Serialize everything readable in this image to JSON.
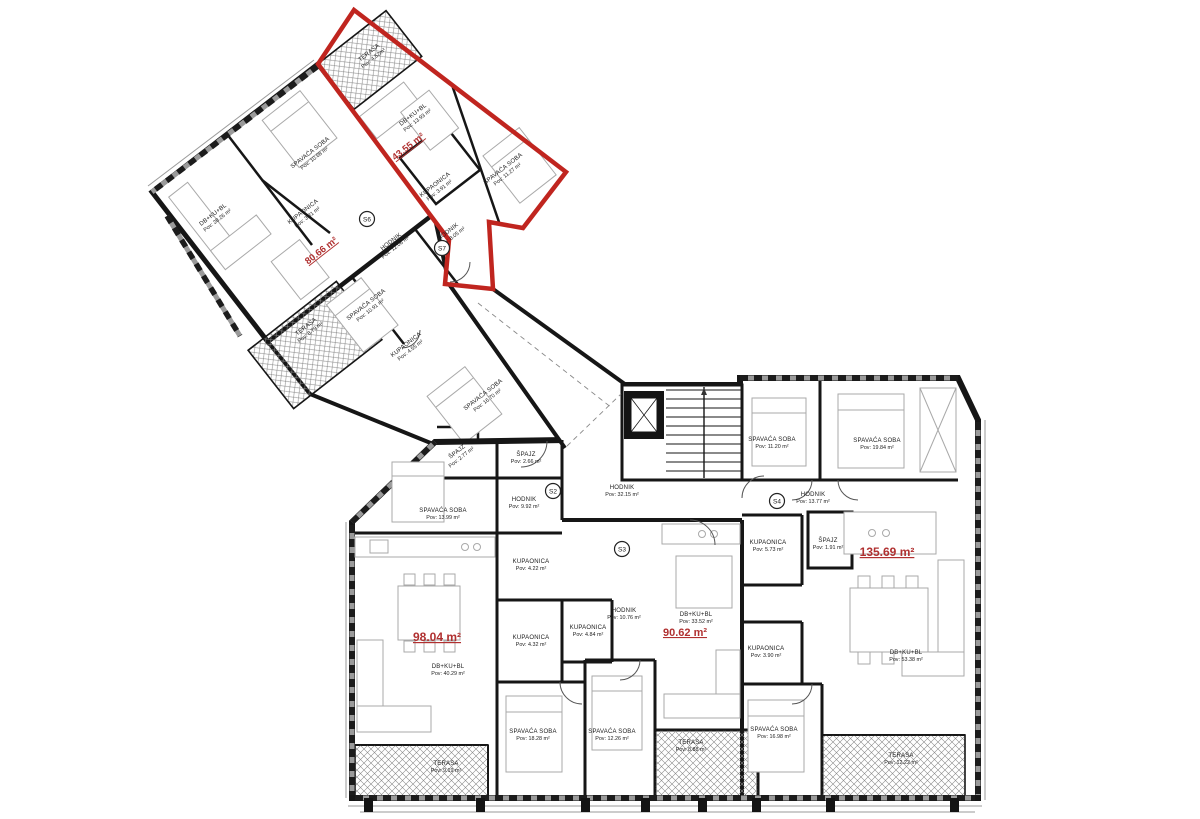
{
  "colors": {
    "wall": "#161616",
    "unit_accent": "#b03030",
    "terrace_hatch": "#8a8a8a",
    "furniture": "#a9a9a9"
  },
  "units": [
    {
      "name": "unit-area-4355",
      "label": "43.55 m²",
      "x": 410,
      "y": 149,
      "rot": -38,
      "size": 9.5
    },
    {
      "name": "unit-area-8066",
      "label": "80.66 m²",
      "x": 323,
      "y": 253,
      "rot": -38,
      "size": 9.5
    },
    {
      "name": "unit-area-9804",
      "label": "98.04 m²",
      "x": 437,
      "y": 641,
      "rot": 0,
      "size": 12
    },
    {
      "name": "unit-area-9062",
      "label": "90.62 m²",
      "x": 685,
      "y": 636,
      "rot": 0,
      "size": 11
    },
    {
      "name": "unit-area-13569",
      "label": "135.69 m²",
      "x": 887,
      "y": 556,
      "rot": 0,
      "size": 12
    }
  ],
  "rooms": [
    {
      "name": "terasa-red",
      "l1": "TERASA",
      "l2": "Pov: 4.52m²",
      "x": 370,
      "y": 54,
      "rot": -38
    },
    {
      "name": "db-red",
      "l1": "DB+KU+BL",
      "l2": "Pov: 13.93 m²",
      "x": 414,
      "y": 116,
      "rot": -38
    },
    {
      "name": "spavaca-red",
      "l1": "SPAVAĆA SOBA",
      "l2": "Pov: 11.27 m²",
      "x": 504,
      "y": 170,
      "rot": -38
    },
    {
      "name": "kupaonica-red",
      "l1": "KUPAONICA",
      "l2": "Pov: 3.91 m²",
      "x": 436,
      "y": 186,
      "rot": -38
    },
    {
      "name": "hodnik-red",
      "l1": "HODNIK",
      "l2": "Pov: 8.05 m²",
      "x": 449,
      "y": 233,
      "rot": -38
    },
    {
      "name": "hodnik-left",
      "l1": "HODNIK",
      "l2": "Pov: 12.06 m²",
      "x": 392,
      "y": 243,
      "rot": -38
    },
    {
      "name": "db-left",
      "l1": "DB+KU+BL",
      "l2": "Pov: 28.26 m²",
      "x": 214,
      "y": 216,
      "rot": -38
    },
    {
      "name": "spavaca-left",
      "l1": "SPAVAĆA SOBA",
      "l2": "Pov: 10.68 m²",
      "x": 311,
      "y": 154,
      "rot": -38
    },
    {
      "name": "kupaonica-left",
      "l1": "KUPAONICA",
      "l2": "Pov: 3.81 m²",
      "x": 304,
      "y": 213,
      "rot": -38
    },
    {
      "name": "spavaca-band1",
      "l1": "SPAVAĆA SOBA",
      "l2": "Pov: 10.91 m²",
      "x": 367,
      "y": 306,
      "rot": -38
    },
    {
      "name": "kupaonica-band",
      "l1": "KUPAONICA",
      "l2": "Pov: 4.55 m²",
      "x": 407,
      "y": 346,
      "rot": -38
    },
    {
      "name": "spavaca-band2",
      "l1": "SPAVAĆA SOBA",
      "l2": "Pov: 16.70 m²",
      "x": 484,
      "y": 396,
      "rot": -38
    },
    {
      "name": "terasa-left",
      "l1": "TERASA",
      "l2": "Pov: 8.79 m²",
      "x": 307,
      "y": 328,
      "rot": -38
    },
    {
      "name": "spajz-277",
      "l1": "ŠPAJZ",
      "l2": "Pov: 2.77 m²",
      "x": 458,
      "y": 453,
      "rot": -38
    },
    {
      "name": "spajz-266",
      "l1": "ŠPAJZ",
      "l2": "Pov: 2.66 m²",
      "x": 526,
      "y": 456,
      "rot": 0
    },
    {
      "name": "hodnik-992",
      "l1": "HODNIK",
      "l2": "Pov: 9.92 m²",
      "x": 524,
      "y": 501,
      "rot": 0
    },
    {
      "name": "hodnik-3215",
      "l1": "HODNIK",
      "l2": "Pov: 32.15 m²",
      "x": 622,
      "y": 489,
      "rot": 0
    },
    {
      "name": "spavaca-1399",
      "l1": "SPAVAĆA SOBA",
      "l2": "Pov: 13.99 m²",
      "x": 443,
      "y": 512,
      "rot": 0
    },
    {
      "name": "kupaonica-422",
      "l1": "KUPAONICA",
      "l2": "Pov: 4.22 m²",
      "x": 531,
      "y": 563,
      "rot": 0
    },
    {
      "name": "kupaonica-432",
      "l1": "KUPAONICA",
      "l2": "Pov: 4.32 m²",
      "x": 531,
      "y": 639,
      "rot": 0
    },
    {
      "name": "kupaonica-484",
      "l1": "KUPAONICA",
      "l2": "Pov: 4.84 m²",
      "x": 588,
      "y": 629,
      "rot": 0
    },
    {
      "name": "hodnik-1076",
      "l1": "HODNIK",
      "l2": "Pov: 10.76 m²",
      "x": 624,
      "y": 612,
      "rot": 0
    },
    {
      "name": "db-9804",
      "l1": "DB+KU+BL",
      "l2": "Pov: 40.29 m²",
      "x": 448,
      "y": 668,
      "rot": 0
    },
    {
      "name": "spavaca-1828",
      "l1": "SPAVAĆA SOBA",
      "l2": "Pov: 18.28 m²",
      "x": 533,
      "y": 733,
      "rot": 0
    },
    {
      "name": "terasa-919",
      "l1": "TERASA",
      "l2": "Pov: 9.19 m²",
      "x": 446,
      "y": 765,
      "rot": 0
    },
    {
      "name": "spavaca-1226",
      "l1": "SPAVAĆA SOBA",
      "l2": "Pov: 12.26 m²",
      "x": 612,
      "y": 733,
      "rot": 0
    },
    {
      "name": "terasa-888",
      "l1": "TERASA",
      "l2": "Pov: 8.88 m²",
      "x": 691,
      "y": 744,
      "rot": 0
    },
    {
      "name": "db-9062",
      "l1": "DB+KU+BL",
      "l2": "Pov: 33.52 m²",
      "x": 696,
      "y": 616,
      "rot": 0
    },
    {
      "name": "kupaonica-573",
      "l1": "KUPAONICA",
      "l2": "Pov: 5.73 m²",
      "x": 768,
      "y": 544,
      "rot": 0
    },
    {
      "name": "spavaca-1120",
      "l1": "SPAVAĆA SOBA",
      "l2": "Pov: 11.20 m²",
      "x": 772,
      "y": 441,
      "rot": 0
    },
    {
      "name": "spavaca-1984",
      "l1": "SPAVAĆA SOBA",
      "l2": "Pov: 19.84 m²",
      "x": 877,
      "y": 442,
      "rot": 0
    },
    {
      "name": "hodnik-1377",
      "l1": "HODNIK",
      "l2": "Pov: 13.77 m²",
      "x": 813,
      "y": 496,
      "rot": 0
    },
    {
      "name": "spajz-191",
      "l1": "ŠPAJZ",
      "l2": "Pov: 1.91 m²",
      "x": 828,
      "y": 542,
      "rot": 0
    },
    {
      "name": "kupaonica-390",
      "l1": "KUPAONICA",
      "l2": "Pov: 3.90 m²",
      "x": 766,
      "y": 650,
      "rot": 0
    },
    {
      "name": "spavaca-1698",
      "l1": "SPAVAĆA SOBA",
      "l2": "Pov: 16.98 m²",
      "x": 774,
      "y": 731,
      "rot": 0
    },
    {
      "name": "db-13569",
      "l1": "DB+KU+BL",
      "l2": "Pov: 53.38 m²",
      "x": 906,
      "y": 654,
      "rot": 0
    },
    {
      "name": "terasa-1222",
      "l1": "TERASA",
      "l2": "Pov: 12.22 m²",
      "x": 901,
      "y": 757,
      "rot": 0
    }
  ],
  "markers": [
    {
      "name": "unit-marker-s2",
      "label": "S2",
      "x": 553,
      "y": 491
    },
    {
      "name": "unit-marker-s3",
      "label": "S3",
      "x": 622,
      "y": 549
    },
    {
      "name": "unit-marker-s4",
      "label": "S4",
      "x": 777,
      "y": 501
    },
    {
      "name": "unit-marker-s6",
      "label": "S6",
      "x": 367,
      "y": 219
    },
    {
      "name": "unit-marker-s7",
      "label": "S7",
      "x": 442,
      "y": 248
    }
  ]
}
